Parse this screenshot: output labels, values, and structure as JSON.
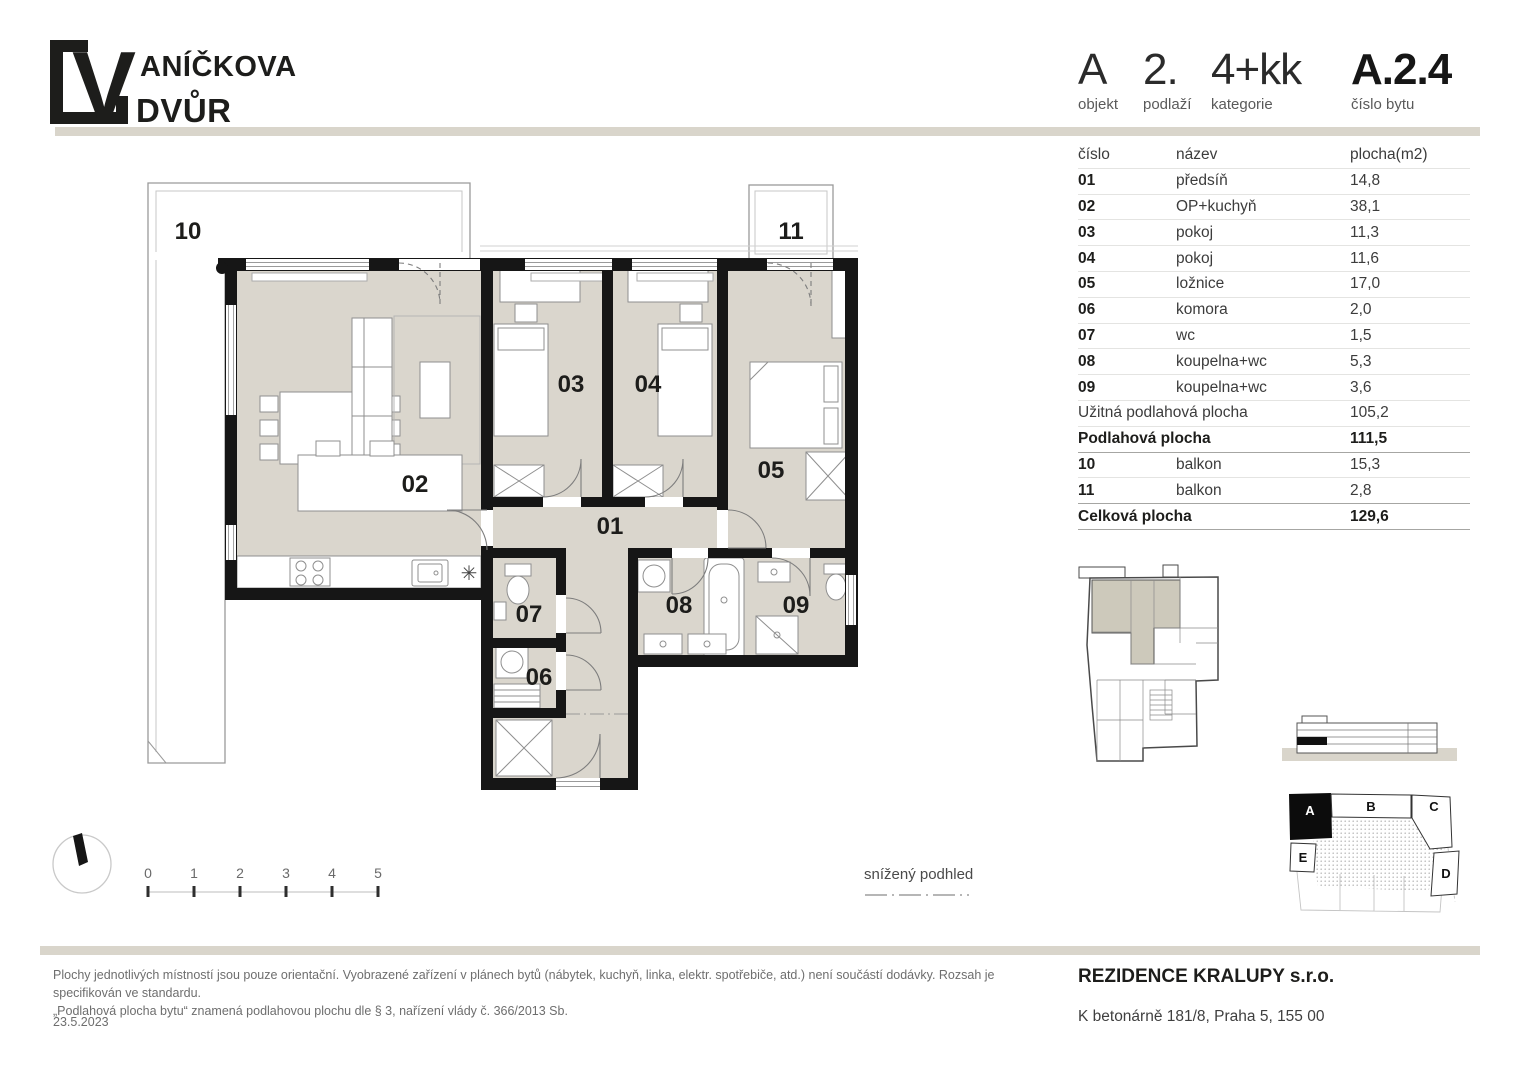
{
  "logo": {
    "mark_letter": "V",
    "line1": "ANÍČKOVA",
    "line2": "DVŮR"
  },
  "header": {
    "object_value": "A",
    "object_label": "objekt",
    "floor_value": "2.",
    "floor_label": "podlaží",
    "category_value": "4+kk",
    "category_label": "kategorie",
    "unit_value": "A.2.4",
    "unit_label": "číslo bytu"
  },
  "table": {
    "header": {
      "number": "číslo",
      "name": "název",
      "area": "plocha(m2)"
    },
    "rooms": [
      {
        "number": "01",
        "name": "předsíň",
        "area": "14,8"
      },
      {
        "number": "02",
        "name": "OP+kuchyň",
        "area": "38,1"
      },
      {
        "number": "03",
        "name": "pokoj",
        "area": "11,3"
      },
      {
        "number": "04",
        "name": "pokoj",
        "area": "11,6"
      },
      {
        "number": "05",
        "name": "ložnice",
        "area": "17,0"
      },
      {
        "number": "06",
        "name": "komora",
        "area": "2,0"
      },
      {
        "number": "07",
        "name": "wc",
        "area": "1,5"
      },
      {
        "number": "08",
        "name": "koupelna+wc",
        "area": "5,3"
      },
      {
        "number": "09",
        "name": "koupelna+wc",
        "area": "3,6"
      }
    ],
    "usable": {
      "label": "Užitná podlahová plocha",
      "value": "105,2"
    },
    "floor_area": {
      "label": "Podlahová plocha",
      "value": "111,5"
    },
    "balconies": [
      {
        "number": "10",
        "name": "balkon",
        "area": "15,3"
      },
      {
        "number": "11",
        "name": "balkon",
        "area": "2,8"
      }
    ],
    "total": {
      "label": "Celková plocha",
      "value": "129,6"
    }
  },
  "plan": {
    "labels": {
      "r01": "01",
      "r02": "02",
      "r03": "03",
      "r04": "04",
      "r05": "05",
      "r06": "06",
      "r07": "07",
      "r08": "08",
      "r09": "09",
      "b10": "10",
      "b11": "11"
    },
    "kitchen_symbol": "✳",
    "legend_lowered_ceiling": "snížený podhled",
    "scale_ticks": [
      "0",
      "1",
      "2",
      "3",
      "4",
      "5"
    ]
  },
  "site": {
    "block_a": "A",
    "block_b": "B",
    "block_c": "C",
    "block_d": "D",
    "block_e": "E"
  },
  "footer": {
    "disclaimer_line1": "Plochy jednotlivých místností jsou pouze orientační. Vyobrazené zařízení v plánech bytů (nábytek, kuchyň, linka, elektr. spotřebiče, atd.) není součástí dodávky. Rozsah je specifikován ve standardu.",
    "disclaimer_line2": "„Podlahová plocha bytu“ znamená podlahovou plochu dle § 3, nařízení vlády č. 366/2013 Sb.",
    "date": "23.5.2023",
    "company": "REZIDENCE KRALUPY s.r.o.",
    "address": "K betonárně 181/8, Praha 5, 155 00"
  }
}
